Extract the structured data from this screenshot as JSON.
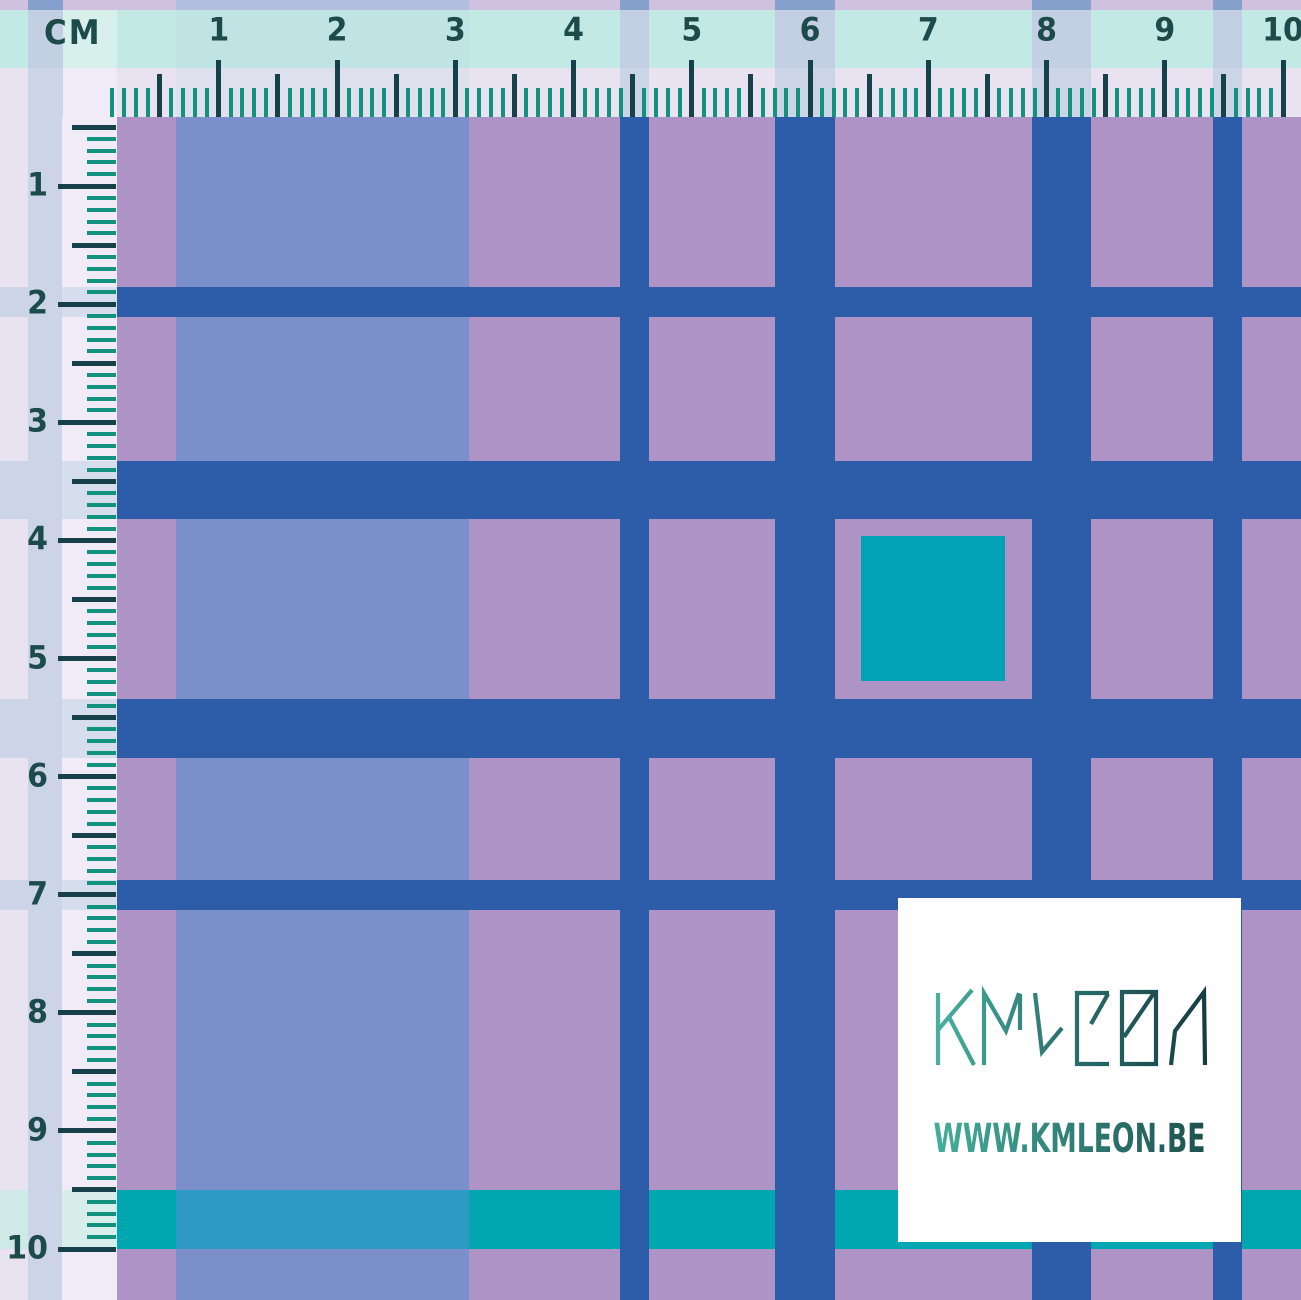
{
  "unit_label": "CM",
  "top_ruler": {
    "numbers": [
      "1",
      "2",
      "3",
      "4",
      "5",
      "6",
      "7",
      "8",
      "9",
      "10"
    ],
    "origin_x": 100.5,
    "cm_spacing": 118.25,
    "mm_ticks": 100
  },
  "left_ruler": {
    "numbers": [
      "1",
      "2",
      "3",
      "4",
      "5",
      "6",
      "7",
      "8",
      "9",
      "10"
    ],
    "origin_y": 68,
    "cm_spacing": 118.1,
    "mm_ticks": 100
  },
  "watermark": {
    "brand": "KMLEON",
    "url": "WWW.KMLEON.BE"
  },
  "colors": {
    "purple": "#ae94c6",
    "periwinkle": "#7b90ca",
    "blue": "#2d5ca8",
    "teal_square": "#00a3b5",
    "teal_row": "#00a7b1",
    "teal_row_on_periwinkle": "#2f9ac6",
    "card_bg": "#ffffff",
    "ruler_cyan": "#c3e9e5",
    "ruler_cyan_on_blue": "#c3d0e4",
    "ruler_cyan_on_periwinkle": "#c0e3e3",
    "ruler_cyan_light": "#d7f0ec",
    "ruler_lavender": "#e9e2f1",
    "ruler_lavender_on_blue": "#ccd5e8",
    "ruler_lavender_on_periwinkle": "#dfe0ee",
    "ruler_lavender_on_teal": "#cfe9e6",
    "ruler_light": "#f0ebf6",
    "ruler_light_on_blue": "#d6deed",
    "ruler_light_on_teal": "#d8eeea",
    "tick_minor": "#12917e",
    "tick_major": "#16404a",
    "number_text": "#1d4a4a",
    "logo_gradient": [
      "#48b3a0",
      "#2a6e6c",
      "#143a40"
    ],
    "url_gradient": [
      "#44b19c",
      "#1d4f4f"
    ]
  },
  "pattern": {
    "width": 1301,
    "height": 1300,
    "base_color": "purple",
    "columns": [
      {
        "name": "margin-blue-column",
        "x": 28,
        "w": 35,
        "color": "blue"
      },
      {
        "name": "periwinkle-column",
        "x": 176,
        "w": 293,
        "color": "periwinkle"
      },
      {
        "name": "blue-narrow-column-1",
        "x": 620,
        "w": 29,
        "color": "blue"
      },
      {
        "name": "blue-wide-column-1",
        "x": 775,
        "w": 60,
        "color": "blue"
      },
      {
        "name": "blue-wide-column-2",
        "x": 1032,
        "w": 59,
        "color": "blue"
      },
      {
        "name": "blue-narrow-column-2",
        "x": 1213,
        "w": 29,
        "color": "blue"
      }
    ],
    "rows": [
      {
        "name": "blue-narrow-row-1",
        "y": 287,
        "h": 30,
        "color": "blue"
      },
      {
        "name": "blue-wide-row-1",
        "y": 461,
        "h": 58,
        "color": "blue"
      },
      {
        "name": "blue-wide-row-2",
        "y": 699,
        "h": 59,
        "color": "blue"
      },
      {
        "name": "blue-narrow-row-2",
        "y": 880,
        "h": 30,
        "color": "blue"
      },
      {
        "name": "teal-stripe-row",
        "y": 1190,
        "h": 59,
        "color": "teal_row"
      }
    ],
    "teal_square": {
      "x": 861,
      "y": 536,
      "w": 144,
      "h": 145
    },
    "ruler_bands": {
      "pale_sliver": {
        "y": 0,
        "h": 10
      },
      "cyan_band": {
        "y": 10,
        "h": 58
      },
      "lavender_band": {
        "y": 68,
        "h": 49
      },
      "left_number_strip": {
        "x": 0,
        "w": 62
      },
      "left_tick_strip": {
        "x": 62,
        "w": 55
      }
    }
  }
}
